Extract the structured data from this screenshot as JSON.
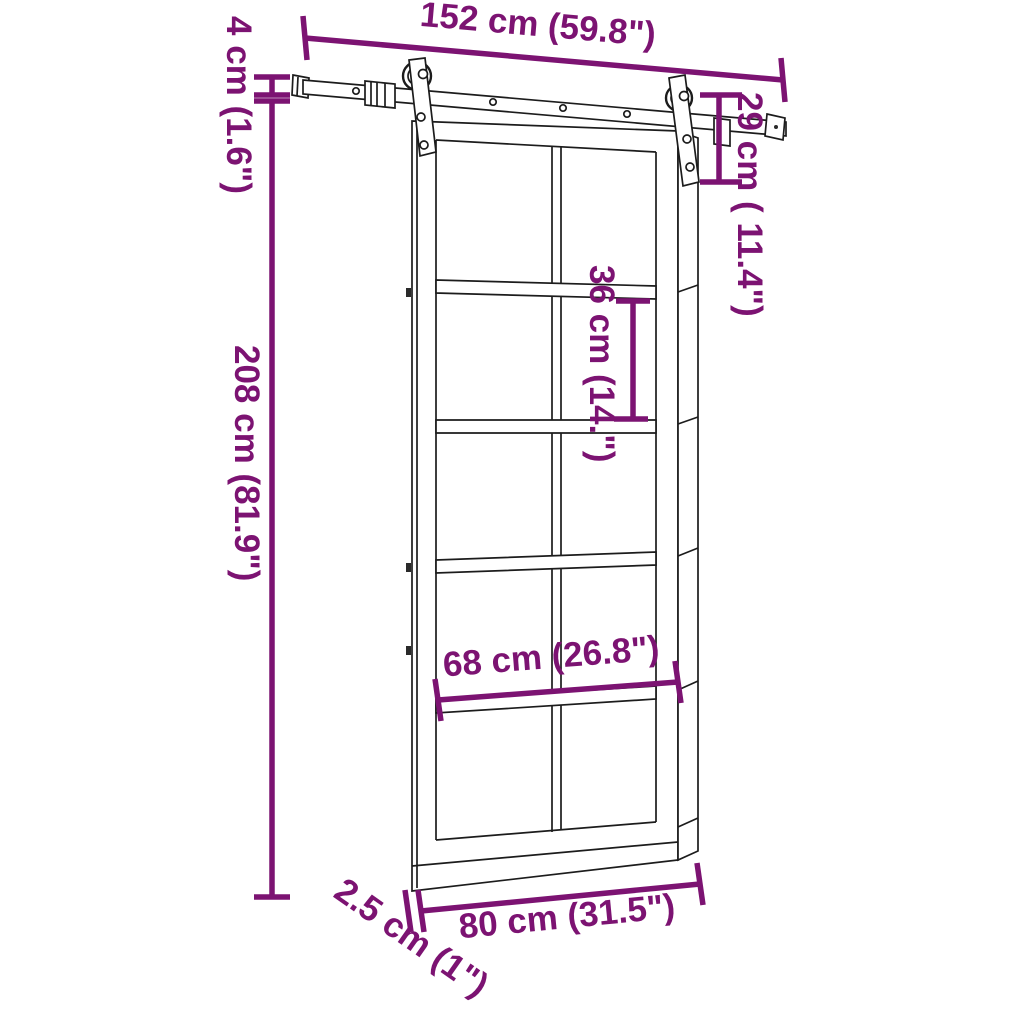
{
  "diagram": {
    "title": "Sliding barn door with hardware kit - dimension drawing",
    "colors": {
      "dimension": "#7C1372",
      "line": "#1c1c1c",
      "mark": "#2a2a2a",
      "background": "#ffffff"
    },
    "dimensions": {
      "rail_length": "152 cm (59.8\")",
      "rail_clearance": "4 cm (1.6\")",
      "hanger_drop": "29 cm ( 11.4\")",
      "door_height": "208 cm (81.9\")",
      "pane_height": "36 cm (14.\")",
      "glass_width": "68 cm (26.8\")",
      "door_width": "80 cm (31.5\")",
      "door_thickness": "2.5 cm (1\")"
    }
  }
}
